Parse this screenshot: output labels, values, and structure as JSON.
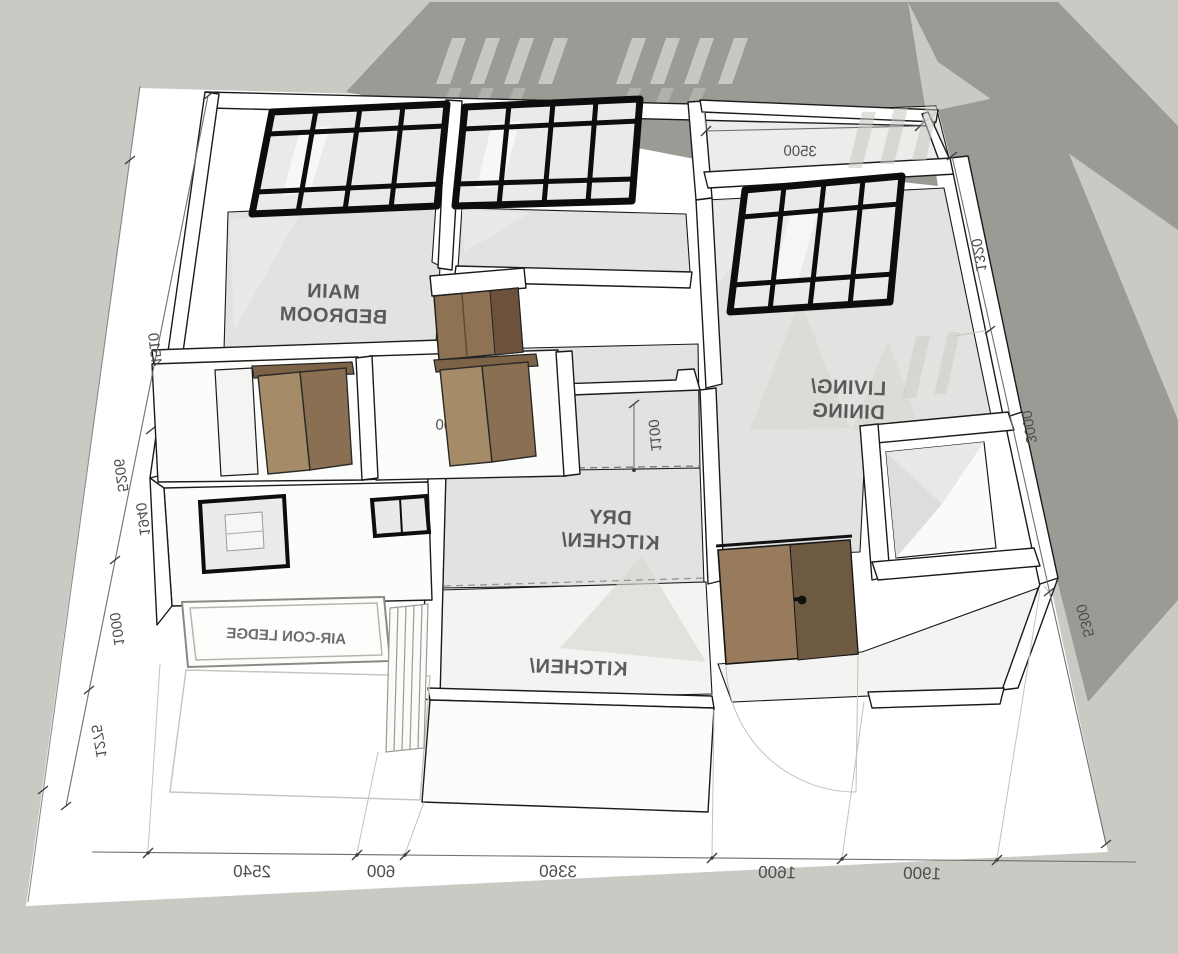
{
  "scene": {
    "type": "3d-floorplan-render-mirrored",
    "colors": {
      "background": "#cac9c4",
      "watermark_gray": "#9b9b96",
      "ground": "#ffffff",
      "floor": "#e2e2e0",
      "wall_outline": "#1a1a1a",
      "window_frame": "#0d0d0d",
      "door_wood_light": "#977b5c",
      "door_wood_dark": "#6e5941",
      "dimension_text": "#4e4e4e",
      "room_text": "#3d3d3d"
    }
  },
  "rooms": {
    "main_bedroom": {
      "l1": "MAIN",
      "l2": "BEDROOM"
    },
    "living_dining": {
      "l1": "LIVING/",
      "l2": "DINING"
    },
    "dry_kitchen": {
      "l1": "DRY",
      "l2": "KITCHEN/"
    },
    "kitchen": {
      "l1": "KITCHEN/"
    },
    "aircon_ledge": {
      "l1": "AIR-CON LEDGE"
    }
  },
  "dims": {
    "top": "3500",
    "win_bed1": "3500",
    "win_bed2": "3000",
    "win_bed2_sill": "850",
    "hall": "1100",
    "bath_left": "940",
    "bath_right": "2200",
    "bottom": [
      "2540",
      "600",
      "3360",
      "1600",
      "1900"
    ],
    "left": [
      "4510",
      "5206",
      "1940",
      "1000",
      "1275"
    ],
    "right": [
      "1320",
      "3000",
      "5300"
    ]
  }
}
